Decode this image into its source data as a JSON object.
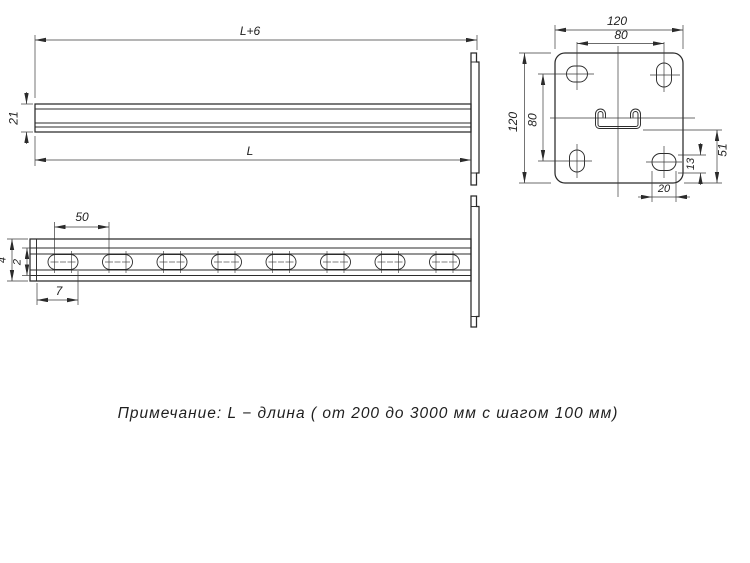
{
  "drawing": {
    "title_semantic": "strut-cantilever-technical-drawing",
    "note": "Примечание: L − длина ( от 200 до 3000 мм с шагом 100 мм)",
    "side_view": {
      "dim_overall_length": "L+6",
      "dim_profile_height": "21",
      "dim_length": "L"
    },
    "plan_view": {
      "dim_slot_pitch": "50",
      "dim_end_offset": "7",
      "dim_outer": "4",
      "dim_inner": "2"
    },
    "plate_view": {
      "dim_plate_width": "120",
      "dim_hole_spacing_x": "80",
      "dim_plate_height": "120",
      "dim_hole_spacing_y": "80",
      "dim_channel_to_edge": "51",
      "dim_hole_height": "13",
      "dim_hole_width": "20"
    }
  },
  "colors": {
    "line": "#2b2b2b",
    "background": "#ffffff",
    "text": "#1f1f1f"
  }
}
